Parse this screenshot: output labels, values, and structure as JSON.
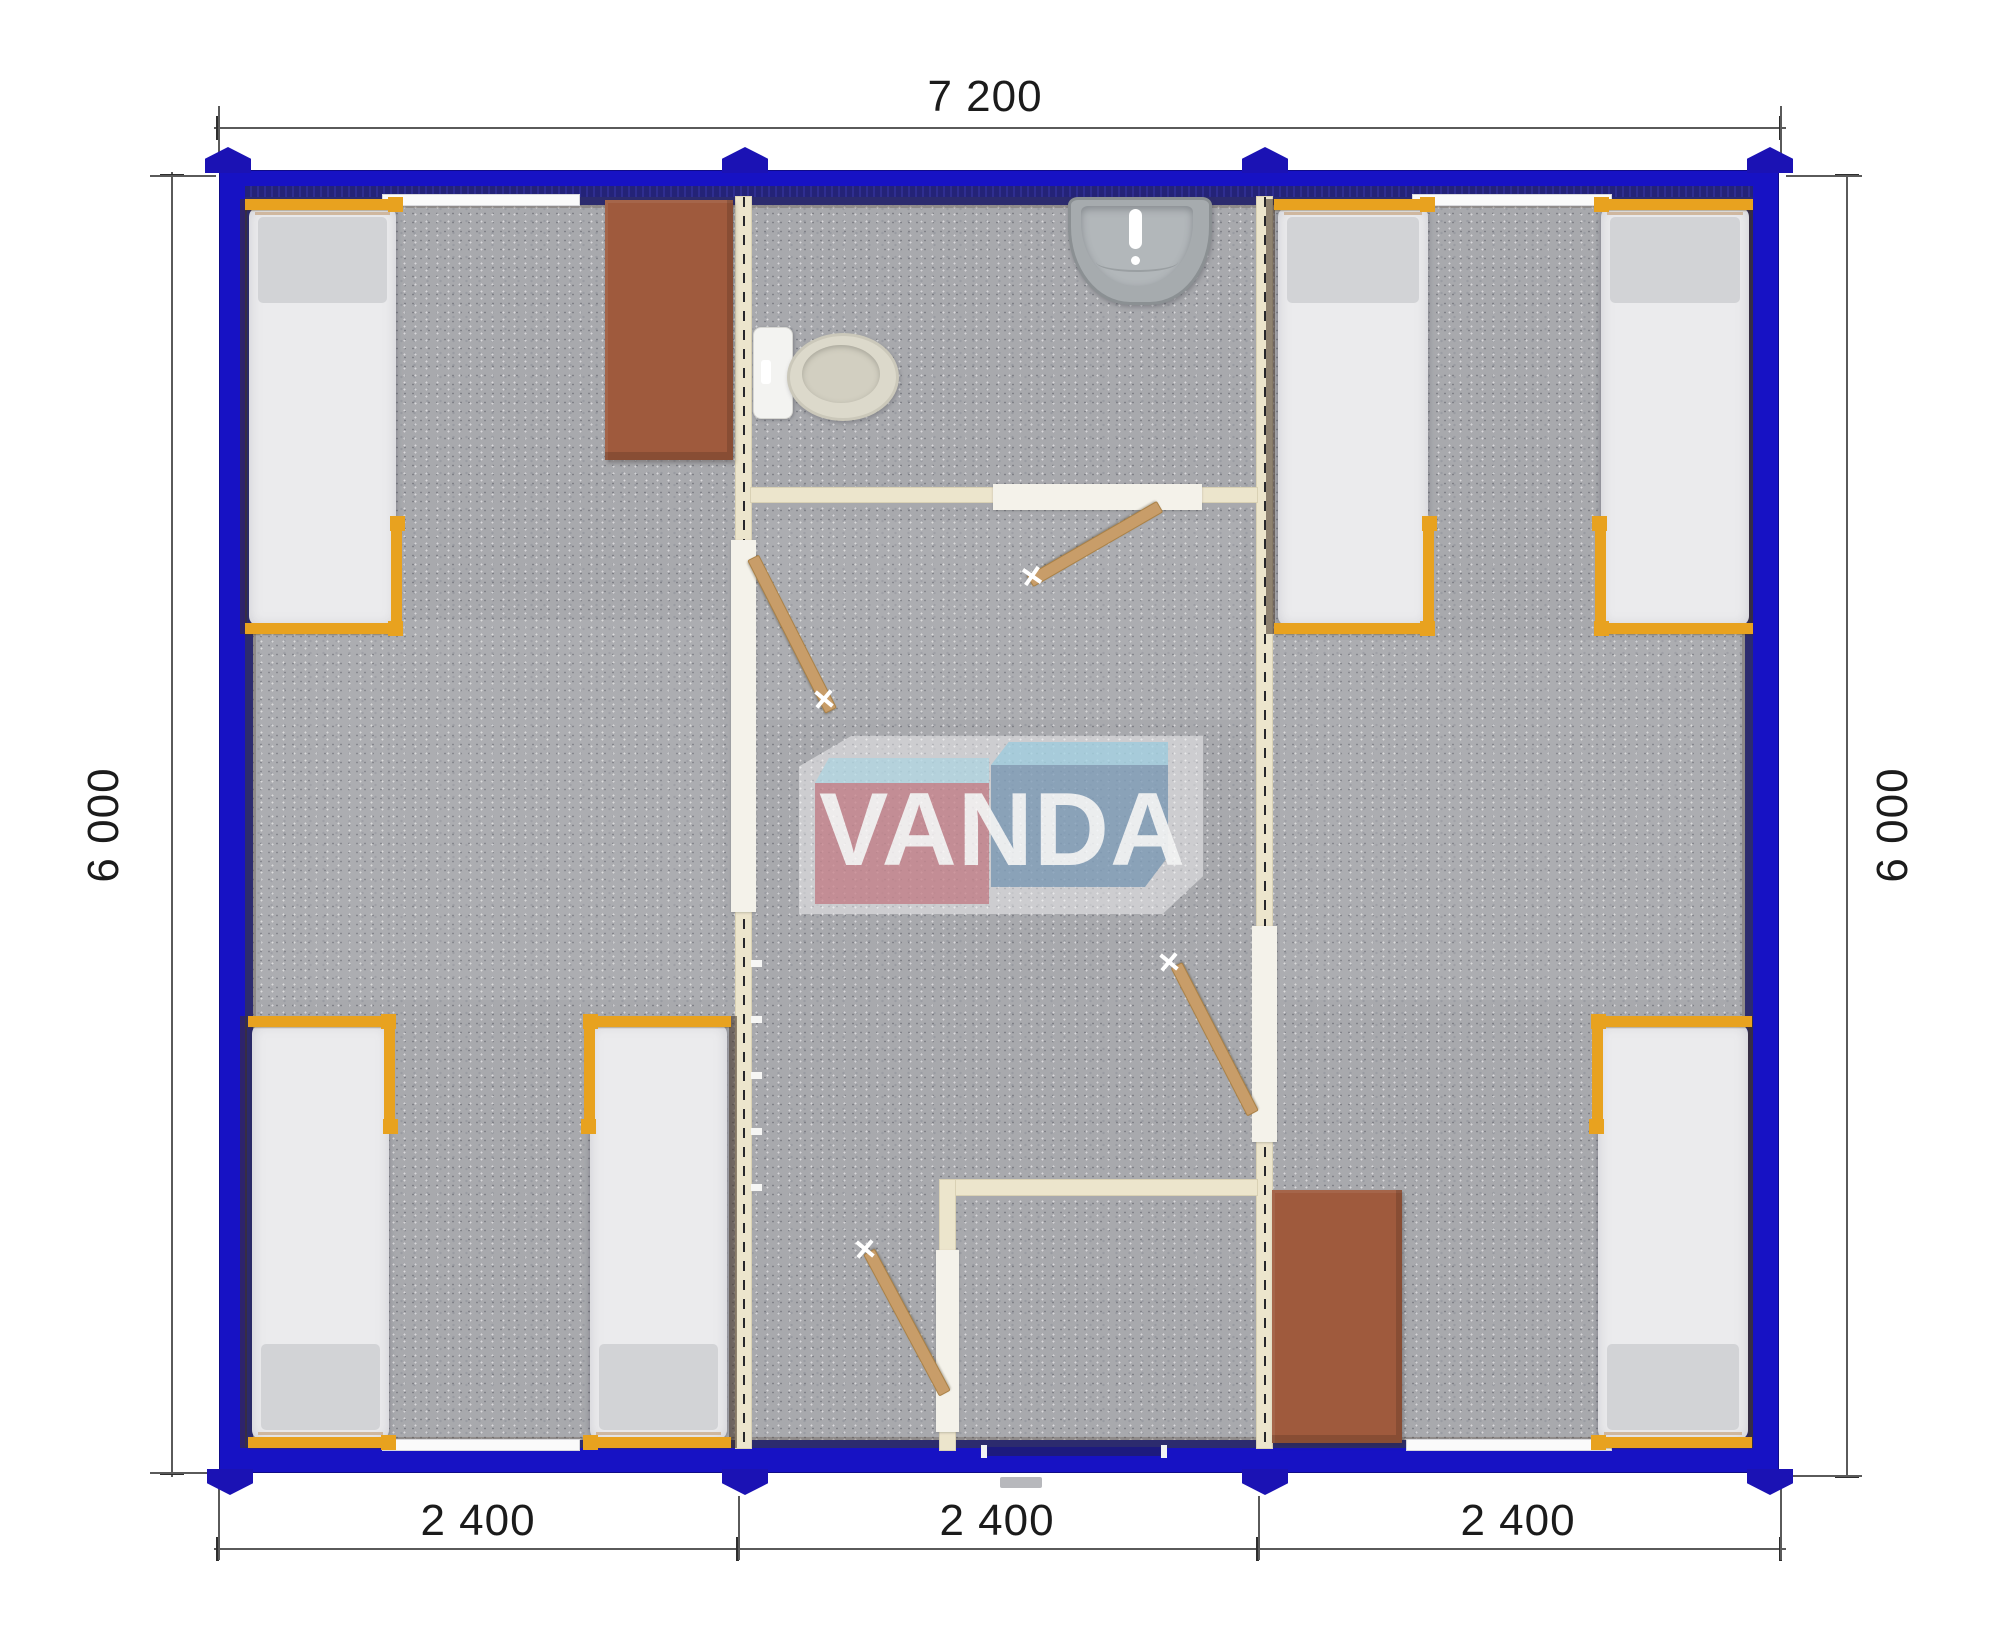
{
  "dimensions": {
    "top": "7 200",
    "left": "6 000",
    "right": "6 000",
    "bottom": [
      "2 400",
      "2 400",
      "2 400"
    ]
  },
  "logo": {
    "text": "VANDA",
    "red": "#c68088",
    "blue": "#7e9cb8",
    "light_blue": "#a2d2e3"
  },
  "palette": {
    "wall_blue": "#1712c4",
    "wall_inner_navy": "#2c2b6e",
    "partition_cream": "#ece5cc",
    "floor_gray": "#a8a9ad",
    "bed_frame_orange": "#e8a21f",
    "table_brown": "#9f5a3d",
    "door_wood": "#c89d69"
  }
}
